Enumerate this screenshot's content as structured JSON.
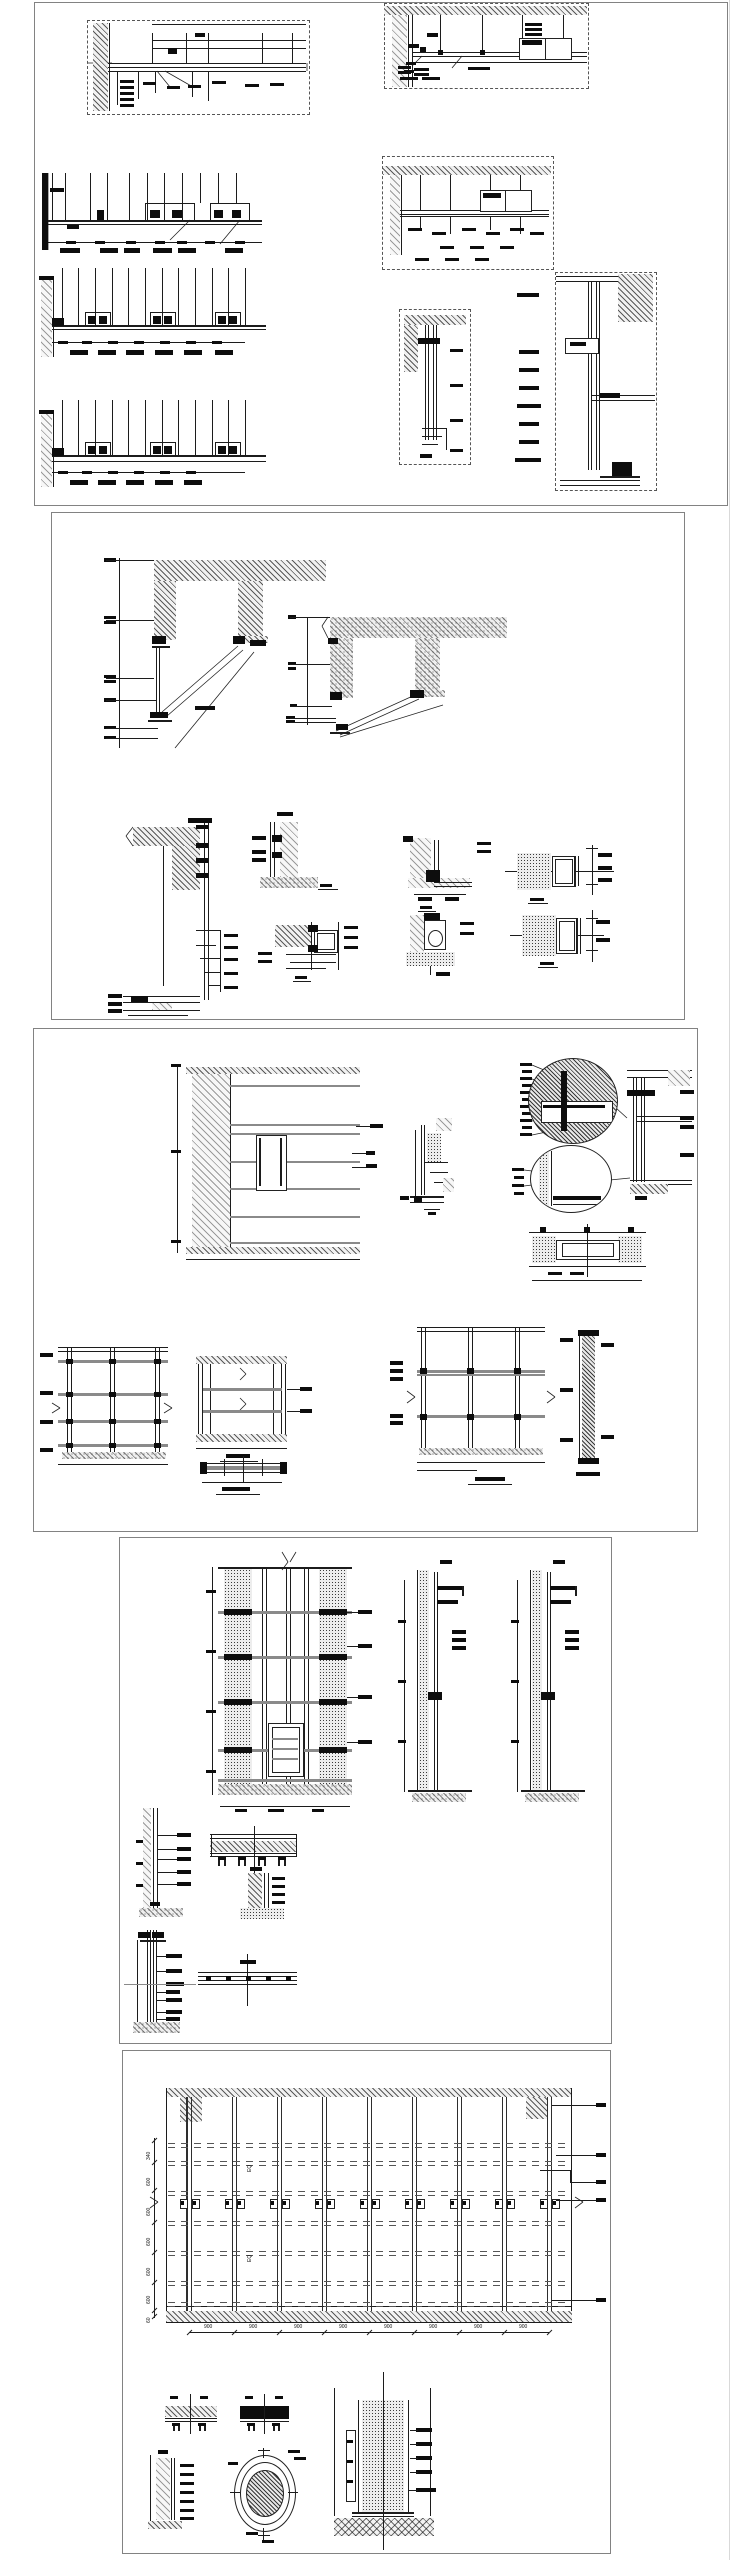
{
  "sheet": {
    "background_color": "#ffffff",
    "line_color": "#1c1c1c",
    "panel_border_color": "#828282",
    "panel_count": 5
  },
  "panels": [
    {
      "id": "panel-1"
    },
    {
      "id": "panel-2"
    },
    {
      "id": "panel-3"
    },
    {
      "id": "panel-4"
    },
    {
      "id": "panel-5"
    }
  ],
  "panel5": {
    "left_dims": [
      "340",
      "600",
      "600",
      "600",
      "600",
      "600",
      "60"
    ],
    "bottom_dims": [
      "900",
      "900",
      "900",
      "900",
      "900",
      "900",
      "900",
      "900"
    ],
    "eq_labels": [
      "EQ",
      "EQ"
    ]
  }
}
